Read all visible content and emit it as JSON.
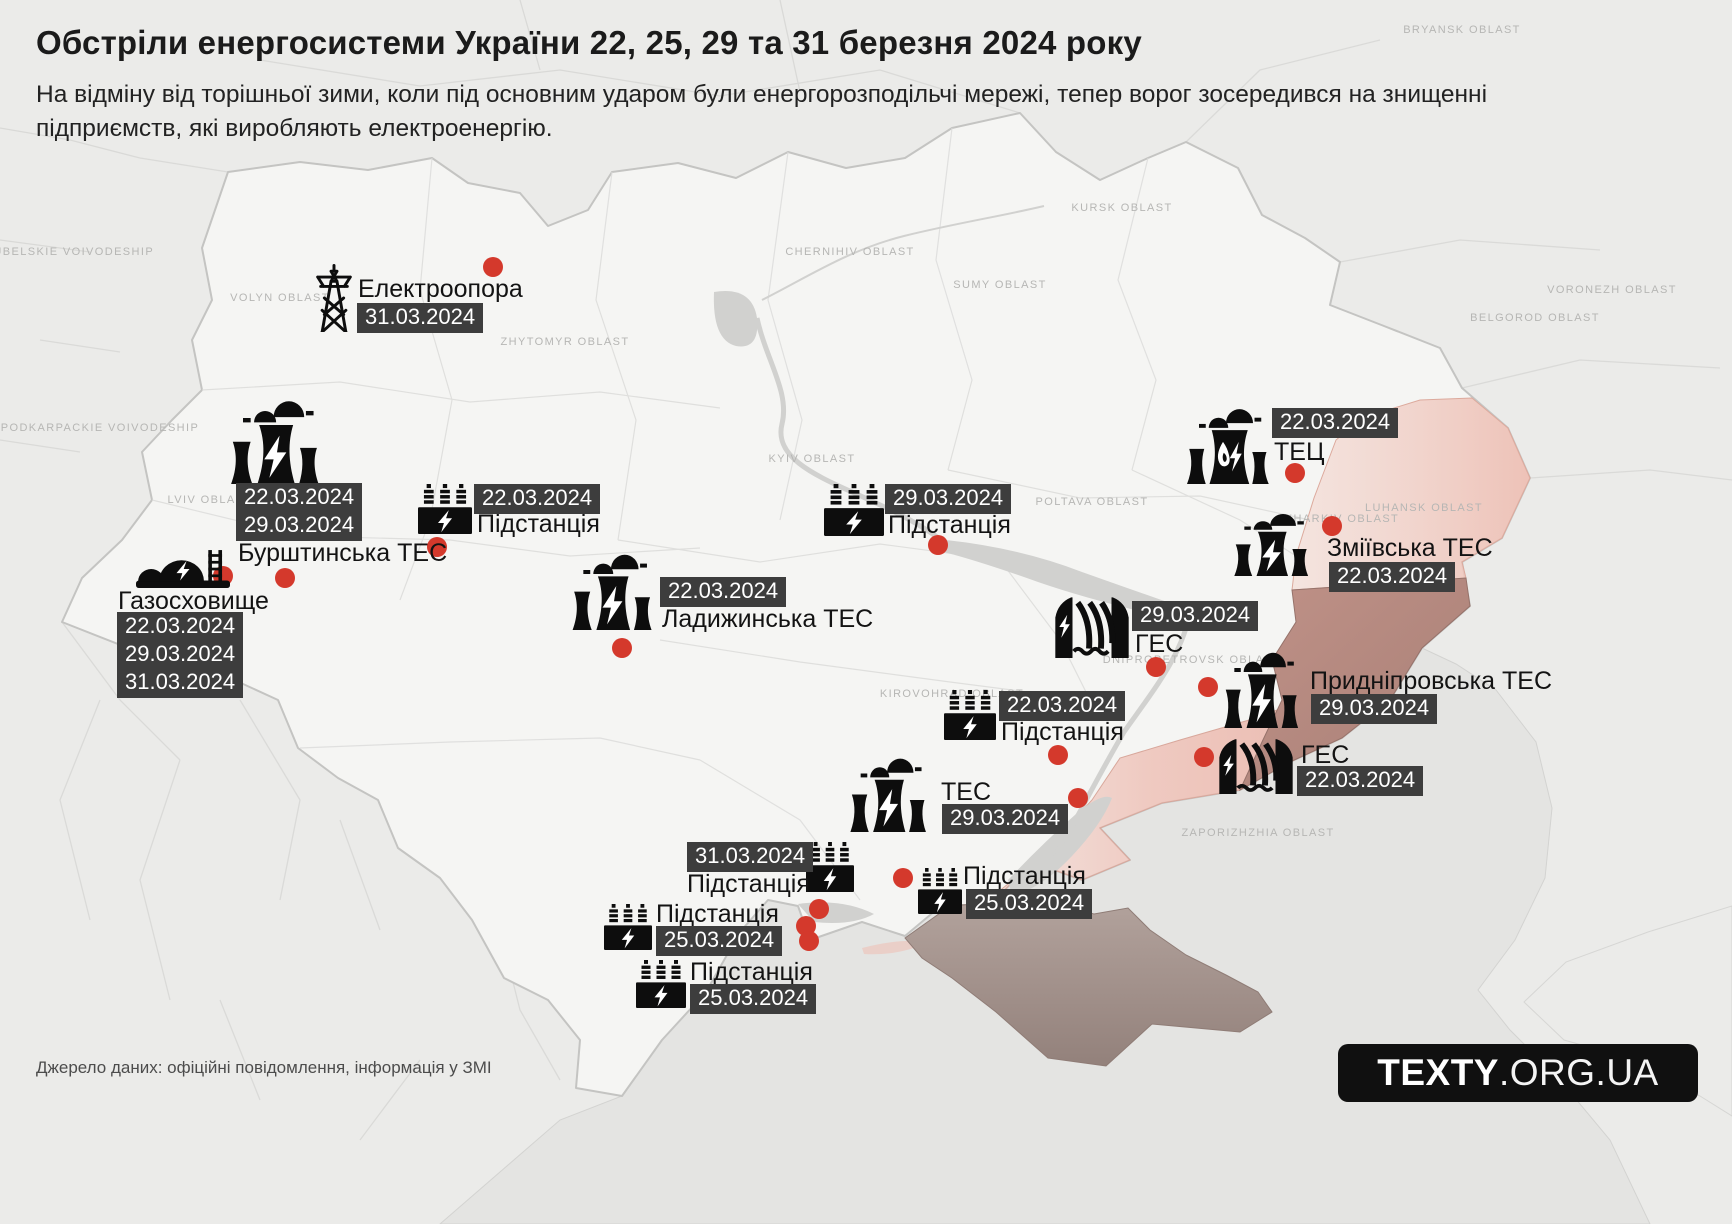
{
  "header": {
    "title": "Обстріли енергосистеми України 22, 25, 29 та 31 березня 2024 року",
    "subtitle": "На відміну від торішньої зими, коли під основним ударом були енергорозподільчі мережі, тепер ворог зосередився на знищенні підприємств, які виробляють електроенергію."
  },
  "footer": {
    "source": "Джерело даних: офіційні повідомлення, інформація у ЗМІ",
    "logo_bold": "TEXTY",
    "logo_rest": ".ORG.UA"
  },
  "colors": {
    "background": "#ebebe9",
    "ukraine_fill": "#f5f5f3",
    "sea": "#e4e4e2",
    "badge_bg": "#3d3d3d",
    "badge_text": "#ffffff",
    "label_text": "#131313",
    "strike_dot": "#d4392c",
    "occupied_south": "#eec2b8",
    "occupied_luhansk": "#f0cec6",
    "occupied_east": "#b0897f",
    "crimea": "#a2908a"
  },
  "markers": [
    {
      "name": "Електроопора",
      "type": "transmission-tower",
      "icon": {
        "x": 314,
        "y": 264,
        "w": 40,
        "h": 68
      },
      "label": {
        "text": "Електроопора",
        "x": 358,
        "y": 276
      },
      "badges": [
        {
          "text": "31.03.2024",
          "x": 357,
          "y": 303
        }
      ]
    },
    {
      "name": "Бурштинська ТЕС",
      "type": "power-plant",
      "icon": {
        "x": 226,
        "y": 396,
        "w": 102,
        "h": 88
      },
      "label": {
        "text": "Бурштинська ТЕС",
        "x": 238,
        "y": 540
      },
      "badges": [
        {
          "text": "22.03.2024",
          "x": 236,
          "y": 483
        },
        {
          "text": "29.03.2024",
          "x": 236,
          "y": 511
        }
      ]
    },
    {
      "name": "Газосховище",
      "type": "gas-storage",
      "icon": {
        "x": 136,
        "y": 546,
        "w": 94,
        "h": 42
      },
      "label": {
        "text": "Газосховище",
        "x": 118,
        "y": 588
      },
      "badges": [
        {
          "text": "22.03.2024",
          "x": 117,
          "y": 612
        },
        {
          "text": "29.03.2024",
          "x": 117,
          "y": 640
        },
        {
          "text": "31.03.2024",
          "x": 117,
          "y": 668
        }
      ]
    },
    {
      "name": "Підстанція",
      "type": "substation",
      "icon": {
        "x": 418,
        "y": 484,
        "w": 54,
        "h": 50
      },
      "label": {
        "text": "Підстанція",
        "x": 477,
        "y": 511
      },
      "badges": [
        {
          "text": "22.03.2024",
          "x": 474,
          "y": 484
        }
      ]
    },
    {
      "name": "Ладижинська ТЕС",
      "type": "power-plant",
      "icon": {
        "x": 568,
        "y": 550,
        "w": 92,
        "h": 80
      },
      "label": {
        "text": "Ладижинська ТЕС",
        "x": 662,
        "y": 606
      },
      "badges": [
        {
          "text": "22.03.2024",
          "x": 660,
          "y": 577
        }
      ]
    },
    {
      "name": "Підстанція",
      "type": "substation",
      "icon": {
        "x": 824,
        "y": 484,
        "w": 60,
        "h": 52
      },
      "label": {
        "text": "Підстанція",
        "x": 888,
        "y": 512
      },
      "badges": [
        {
          "text": "29.03.2024",
          "x": 885,
          "y": 484
        }
      ]
    },
    {
      "name": "ТЕЦ",
      "type": "chp-plant",
      "icon": {
        "x": 1184,
        "y": 406,
        "w": 90,
        "h": 78
      },
      "label": {
        "text": "ТЕЦ",
        "x": 1274,
        "y": 439
      },
      "badges": [
        {
          "text": "22.03.2024",
          "x": 1272,
          "y": 408
        }
      ]
    },
    {
      "name": "Зміївська ТЕС",
      "type": "power-plant",
      "icon": {
        "x": 1230,
        "y": 510,
        "w": 86,
        "h": 66
      },
      "label": {
        "text": "Зміївська ТЕС",
        "x": 1327,
        "y": 535
      },
      "badges": [
        {
          "text": "22.03.2024",
          "x": 1329,
          "y": 562
        }
      ]
    },
    {
      "name": "ГЕС",
      "type": "hydro-plant",
      "icon": {
        "x": 1054,
        "y": 596,
        "w": 76,
        "h": 62
      },
      "label": {
        "text": "ГЕС",
        "x": 1135,
        "y": 631
      },
      "badges": [
        {
          "text": "29.03.2024",
          "x": 1132,
          "y": 601
        }
      ]
    },
    {
      "name": "Придніпровська ТЕС",
      "type": "power-plant",
      "icon": {
        "x": 1220,
        "y": 648,
        "w": 86,
        "h": 80
      },
      "label": {
        "text": "Придніпровська ТЕС",
        "x": 1310,
        "y": 668
      },
      "badges": [
        {
          "text": "29.03.2024",
          "x": 1311,
          "y": 694
        }
      ]
    },
    {
      "name": "ГЕС",
      "type": "hydro-plant",
      "icon": {
        "x": 1218,
        "y": 738,
        "w": 76,
        "h": 56
      },
      "label": {
        "text": "ГЕС",
        "x": 1301,
        "y": 742
      },
      "badges": [
        {
          "text": "22.03.2024",
          "x": 1297,
          "y": 766
        }
      ]
    },
    {
      "name": "Підстанція",
      "type": "substation",
      "icon": {
        "x": 944,
        "y": 690,
        "w": 52,
        "h": 50
      },
      "label": {
        "text": "Підстанція",
        "x": 1001,
        "y": 719
      },
      "badges": [
        {
          "text": "22.03.2024",
          "x": 999,
          "y": 691
        }
      ]
    },
    {
      "name": "ТЕС",
      "type": "power-plant",
      "icon": {
        "x": 846,
        "y": 754,
        "w": 88,
        "h": 78
      },
      "label": {
        "text": "ТЕС",
        "x": 941,
        "y": 779
      },
      "badges": [
        {
          "text": "29.03.2024",
          "x": 942,
          "y": 804
        }
      ]
    },
    {
      "name": "Підстанція",
      "type": "substation",
      "icon": {
        "x": 806,
        "y": 842,
        "w": 48,
        "h": 50
      },
      "label": {
        "text": "Підстанція",
        "x": 687,
        "y": 871
      },
      "badges": [
        {
          "text": "31.03.2024",
          "x": 687,
          "y": 842
        }
      ]
    },
    {
      "name": "Підстанція",
      "type": "substation",
      "icon": {
        "x": 918,
        "y": 868,
        "w": 44,
        "h": 46
      },
      "label": {
        "text": "Підстанція",
        "x": 963,
        "y": 863
      },
      "badges": [
        {
          "text": "25.03.2024",
          "x": 966,
          "y": 889
        }
      ]
    },
    {
      "name": "Підстанція",
      "type": "substation",
      "icon": {
        "x": 604,
        "y": 904,
        "w": 48,
        "h": 46
      },
      "label": {
        "text": "Підстанція",
        "x": 656,
        "y": 901
      },
      "badges": [
        {
          "text": "25.03.2024",
          "x": 656,
          "y": 926
        }
      ]
    },
    {
      "name": "Підстанція",
      "type": "substation",
      "icon": {
        "x": 636,
        "y": 960,
        "w": 50,
        "h": 48
      },
      "label": {
        "text": "Підстанція",
        "x": 690,
        "y": 959
      },
      "badges": [
        {
          "text": "25.03.2024",
          "x": 690,
          "y": 984
        }
      ]
    }
  ],
  "strike_dots": [
    {
      "x": 493,
      "y": 267
    },
    {
      "x": 223,
      "y": 576
    },
    {
      "x": 285,
      "y": 578
    },
    {
      "x": 437,
      "y": 547
    },
    {
      "x": 622,
      "y": 648
    },
    {
      "x": 938,
      "y": 545
    },
    {
      "x": 1295,
      "y": 473
    },
    {
      "x": 1332,
      "y": 526
    },
    {
      "x": 1156,
      "y": 667
    },
    {
      "x": 1208,
      "y": 687
    },
    {
      "x": 1204,
      "y": 757
    },
    {
      "x": 1058,
      "y": 755
    },
    {
      "x": 1078,
      "y": 798
    },
    {
      "x": 903,
      "y": 878
    },
    {
      "x": 819,
      "y": 909
    },
    {
      "x": 806,
      "y": 926
    },
    {
      "x": 809,
      "y": 941
    }
  ],
  "map_labels": [
    {
      "text": "LUBELSKIE VOIVODESHIP",
      "x": 70,
      "y": 252
    },
    {
      "text": "PODKARPACKIE VOIVODESHIP",
      "x": 100,
      "y": 428
    },
    {
      "text": "VOLYN OBLAST",
      "x": 280,
      "y": 298
    },
    {
      "text": "LVIV OBLAST",
      "x": 210,
      "y": 500
    },
    {
      "text": "ZHYTOMYR OBLAST",
      "x": 565,
      "y": 342
    },
    {
      "text": "CHERNIHIV OBLAST",
      "x": 850,
      "y": 252
    },
    {
      "text": "SUMY OBLAST",
      "x": 1000,
      "y": 285
    },
    {
      "text": "BRYANSK OBLAST",
      "x": 1462,
      "y": 30
    },
    {
      "text": "KURSK OBLAST",
      "x": 1122,
      "y": 208
    },
    {
      "text": "BELGOROD OBLAST",
      "x": 1535,
      "y": 318
    },
    {
      "text": "VORONEZH OBLAST",
      "x": 1612,
      "y": 290
    },
    {
      "text": "KYIV OBLAST",
      "x": 812,
      "y": 459
    },
    {
      "text": "POLTAVA OBLAST",
      "x": 1092,
      "y": 502
    },
    {
      "text": "KHARKIV OBLAST",
      "x": 1342,
      "y": 519
    },
    {
      "text": "LUHANSK OBLAST",
      "x": 1424,
      "y": 508
    },
    {
      "text": "KIROVOHRAD OBLAST",
      "x": 952,
      "y": 694
    },
    {
      "text": "DNIPROPETROVSK OBLAST",
      "x": 1192,
      "y": 660
    },
    {
      "text": "ZAPORIZHZHIA OBLAST",
      "x": 1258,
      "y": 833
    }
  ]
}
